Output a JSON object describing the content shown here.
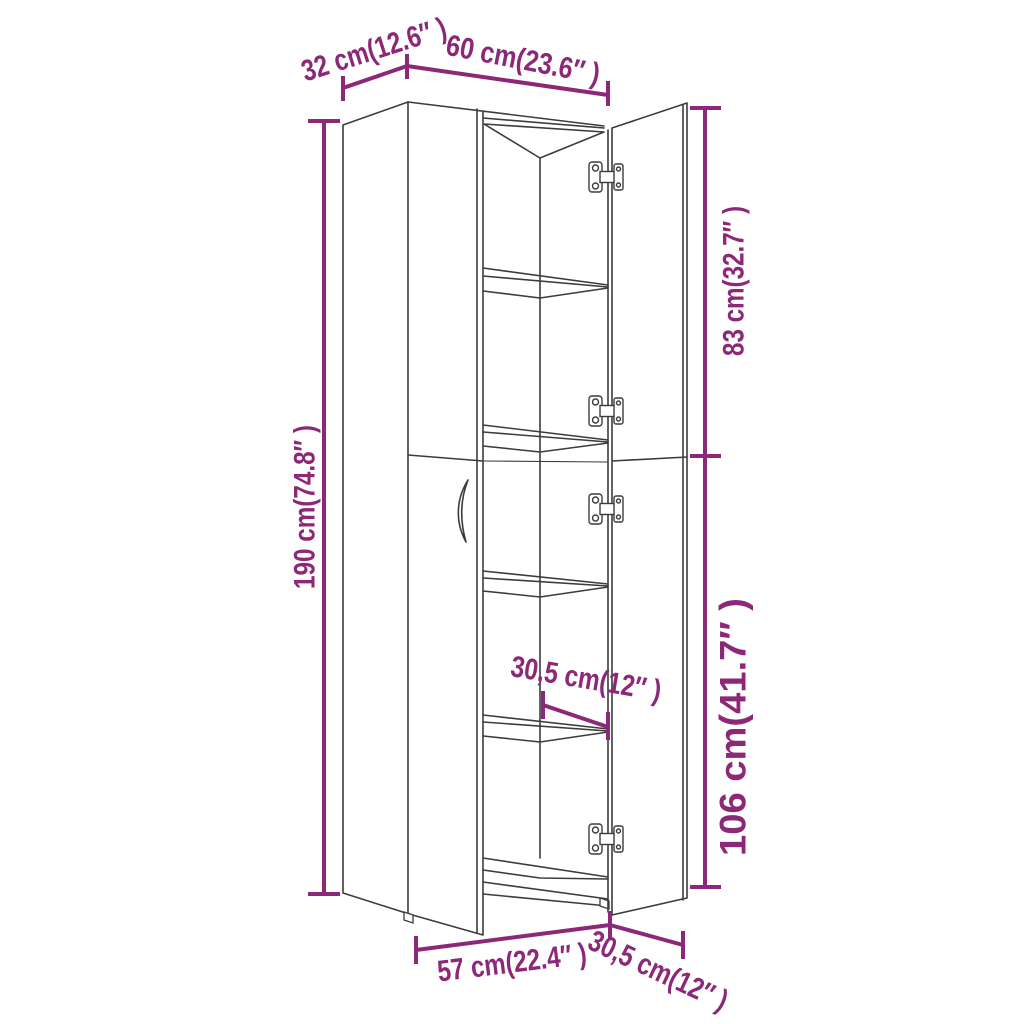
{
  "diagram": {
    "subject": "Tall storage cabinet line drawing with closed left doors and open right doors showing shelves and hinges",
    "view": "perspective product dimension diagram",
    "background": "#FFFFFF",
    "colors": {
      "dimension_accent": "#8C2877",
      "line_art": "#3C3C3C"
    },
    "dimensions": {
      "top_depth": {
        "label": "32 cm(12.6″ )",
        "cm": "32",
        "inches": "12.6"
      },
      "top_width": {
        "label": "60 cm(23.6″ )",
        "cm": "60",
        "inches": "23.6"
      },
      "left_total_height": {
        "label": "190 cm(74.8″ )",
        "cm": "190",
        "inches": "74.8"
      },
      "right_upper_height": {
        "label": "83 cm(32.7″ )",
        "cm": "83",
        "inches": "32.7"
      },
      "right_lower_height": {
        "label": "106 cm(41.7″ )",
        "cm": "106",
        "inches": "41.7"
      },
      "shelf_depth": {
        "label": "30,5 cm(12″ )",
        "cm": "30,5",
        "inches": "12"
      },
      "bottom_width": {
        "label": "57 cm(22.4″ )",
        "cm": "57",
        "inches": "22.4"
      },
      "bottom_depth": {
        "label": "30,5 cm(12″ )",
        "cm": "30,5",
        "inches": "12"
      }
    },
    "features": {
      "shelf_count": "4",
      "hinge_count": "4",
      "handle_count": "1"
    }
  }
}
